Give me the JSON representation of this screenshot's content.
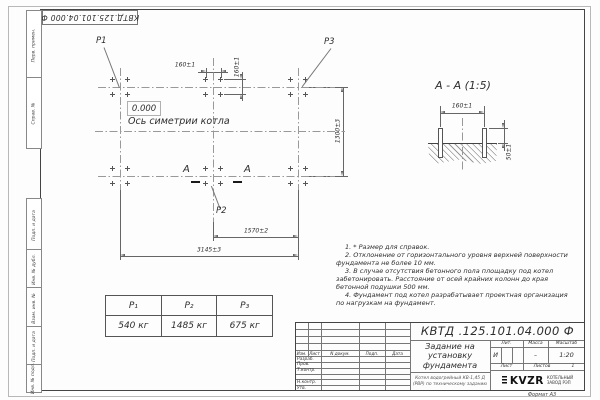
{
  "sheet": {
    "top_stamp": "КВТД.125.101.04.000  Ф",
    "format_note": "Формат А3"
  },
  "side_strips": {
    "top": [
      "Перв. примен.",
      "Справ. №"
    ],
    "bottom": [
      "Подп. и дата",
      "Инв. № дубл.",
      "Взам. инв. №",
      "Подп. и дата",
      "Инв. № подл."
    ]
  },
  "plan": {
    "p1": "P1",
    "p2": "P2",
    "p3": "P3",
    "elevation": "0.000",
    "axis_label": "Ось симетрии котла",
    "section_letter_left": "А",
    "section_letter_right": "А",
    "dim_160_top": "160±1",
    "dim_160_side": "160±1",
    "dim_1300": "1300±3",
    "dim_1570": "1570±2",
    "dim_3145": "3145±3"
  },
  "section": {
    "title": "А - А (1:5)",
    "dim_160": "160±1",
    "dim_50": "50±1"
  },
  "load_table": {
    "headers": [
      "P₁",
      "P₂",
      "P₃"
    ],
    "values": [
      "540 кг",
      "1485 кг",
      "675 кг"
    ]
  },
  "notes": [
    "1. * Размер для справок.",
    "2. Отклонение от горизонтального уровня верхней поверхности фундамента не более 10 мм.",
    "3. В случае отсутствия бетонного пола площадку под котел забетонировать. Расстояние от осей крайних колонн до края бетонной подушки 500 мм.",
    "4. Фундамент под котел разрабатывает проектная организация по нагрузкам на фундамент."
  ],
  "title_block": {
    "doc_number": "КВТД .125.101.04.000  Ф",
    "title": "Задание на установку фундамента",
    "subtitle": "Котел водогрейный КВ-1,45 Д (РВР) по техническому заданию",
    "col_izm": "Изм.",
    "col_list": "Лист",
    "col_doc": "N докум.",
    "col_sign": "Подп.",
    "col_date": "Дата",
    "rows": [
      "Разраб.",
      "Пров.",
      "Т.контр.",
      "",
      "Н.контр.",
      "Утв."
    ],
    "lit_label": "Лит.",
    "mass_label": "Масса",
    "scale_label": "Масштаб",
    "lit_value": "И",
    "mass_value": "–",
    "scale_value": "1:20",
    "sheet_label": "Лист",
    "sheets_label": "Листов",
    "sheets_value": "1",
    "logo_text": "KVZR",
    "company_line1": "КОТЕЛЬНЫЙ",
    "company_line2": "ЗАВОД РЭП"
  }
}
